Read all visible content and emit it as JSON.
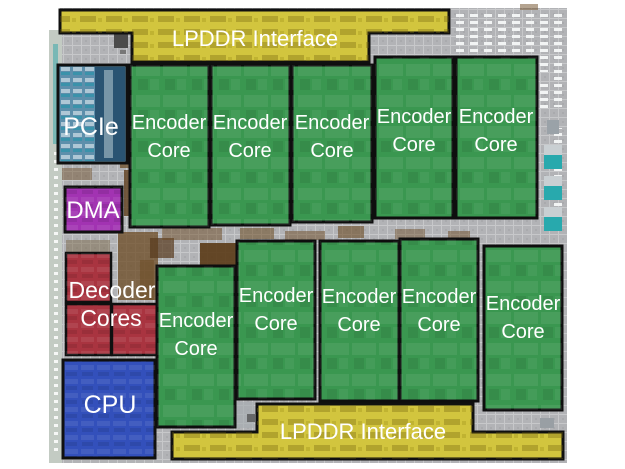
{
  "title": "Chip die floorplan with annotated functional blocks",
  "labels": {
    "lpddr_top": "LPDDR Interface",
    "lpddr_bottom": "LPDDR Interface",
    "pcie": "PCIe",
    "dma": "DMA",
    "decoder_line1": "Decoder",
    "decoder_line2": "Cores",
    "cpu": "CPU",
    "encoder_line1": "Encoder",
    "encoder_line2": "Core"
  },
  "blocks": [
    {
      "name": "lpddr-interface-top",
      "label": "LPDDR Interface",
      "color": "#d2c53e"
    },
    {
      "name": "pcie",
      "label": "PCIe",
      "color": "#5d8fab"
    },
    {
      "name": "dma",
      "label": "DMA",
      "color": "#a233b2"
    },
    {
      "name": "decoder-cores",
      "label": "Decoder Cores",
      "color": "#a93440"
    },
    {
      "name": "cpu",
      "label": "CPU",
      "color": "#3350bb"
    },
    {
      "name": "encoder-core",
      "label": "Encoder Core",
      "count": 10,
      "color": "#3a9750"
    },
    {
      "name": "lpddr-interface-bottom",
      "label": "LPDDR Interface",
      "color": "#d2c53e"
    }
  ],
  "colors": {
    "lpddr": "#d2c53e",
    "encoder": "#3a9750",
    "pcie": "#5d8fab",
    "pcie_dark": "#2a5472",
    "dma": "#a233b2",
    "decoder": "#a93440",
    "cpu": "#3350bb",
    "die_background": "#b3b4b6",
    "block_border": "#101010",
    "label_text": "#ffffff"
  }
}
